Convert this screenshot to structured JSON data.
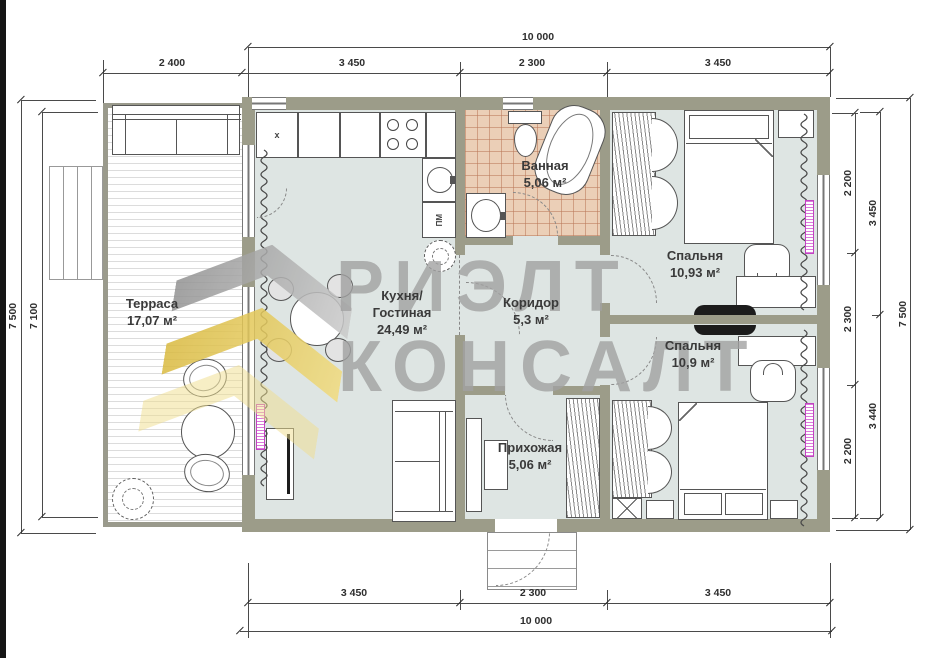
{
  "watermark": {
    "line1": "РИЭЛТ",
    "line2": "КОНСАЛТ"
  },
  "rooms": {
    "terrace": {
      "name": "Терраса",
      "area": "17,07 м²"
    },
    "kitchen": {
      "line1": "Кухня/",
      "line2": "Гостиная",
      "area": "24,49 м²"
    },
    "bathroom": {
      "name": "Ванная",
      "area": "5,06 м²"
    },
    "corridor": {
      "name": "Коридор",
      "area": "5,3 м²"
    },
    "bedroom1": {
      "name": "Спальня",
      "area": "10,93 м²"
    },
    "bedroom2": {
      "name": "Спальня",
      "area": "10,9 м²"
    },
    "hallway": {
      "name": "Прихожая",
      "area": "5,06 м²"
    }
  },
  "kitchen_marks": {
    "dishwasher": "ПМ",
    "corner_cabinet": "x"
  },
  "dims": {
    "top_total": "10 000",
    "top_segments": [
      "2 400",
      "3 450",
      "2 300",
      "3 450"
    ],
    "bottom_segments": [
      "3 450",
      "2 300",
      "3 450"
    ],
    "bottom_total": "10 000",
    "left_outer": "7 500",
    "left_inner": "7 100",
    "right_inner": [
      "2 200",
      "2 300",
      "2 200"
    ],
    "right_middle": [
      "3 450",
      "3 440"
    ],
    "right_outer": "7 500"
  },
  "colors": {
    "wall": "#9c9c89",
    "floor": "#dee5e3",
    "bath_tile": "#ebcfb7",
    "radiator_accent": "#c243c2",
    "watermark_gray": "#a2a2a2",
    "watermark_yellow": "#e8c957"
  }
}
